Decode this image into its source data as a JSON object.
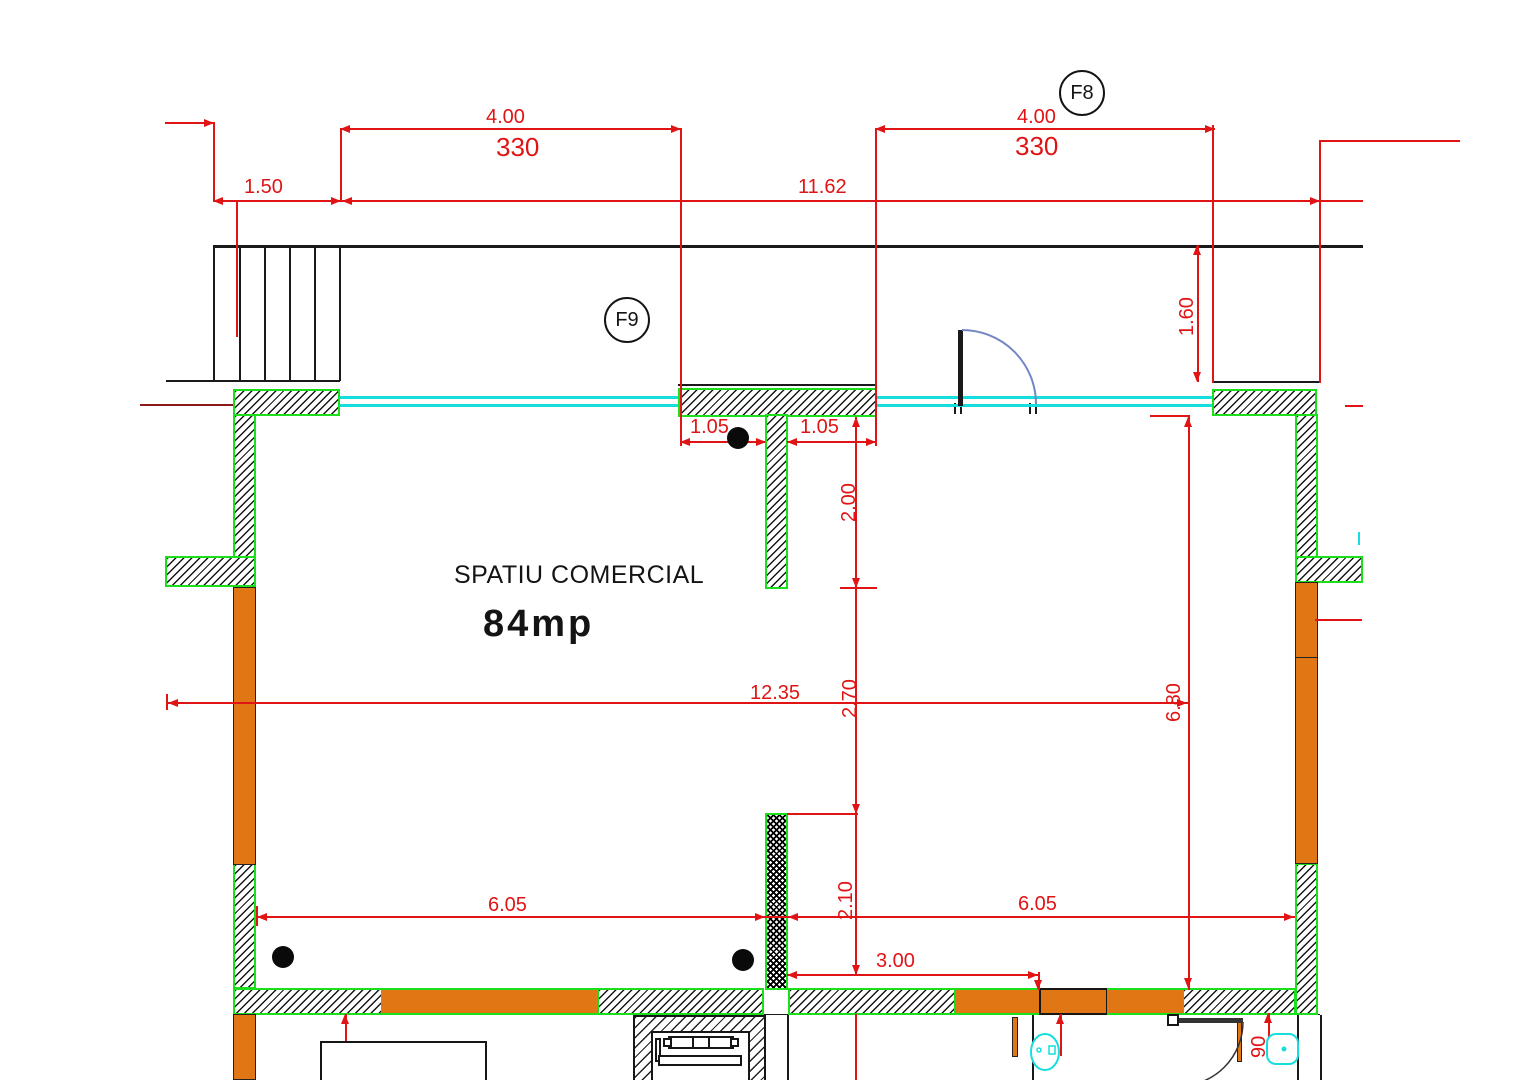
{
  "room": {
    "name": "SPATIU COMERCIAL",
    "area_label": "84mp"
  },
  "grid_bubbles": {
    "f8": "F8",
    "f9": "F9"
  },
  "dimensions": {
    "top_left_offset": "1.50",
    "window_left_width": "4.00",
    "window_left_mm": "330",
    "total_width": "11.62",
    "window_right_width": "4.00",
    "window_right_mm": "330",
    "door_recess_depth": "1.60",
    "pier_left": "1.05",
    "pier_right": "1.05",
    "partition_upper_length": "2.00",
    "room_width": "12.35",
    "mid_depth": "2.70",
    "right_depth": "6.80",
    "bottom_left_width": "6.05",
    "bottom_right_width": "6.05",
    "partition_lower_length": "2.10",
    "opening_width": "3.00",
    "door_width_cm": "90"
  },
  "colors": {
    "dimension_red": "#e01414",
    "wall_outline_green": "#1cdf1c",
    "column_orange": "#e07714",
    "window_cyan": "#17dede",
    "door_arc_blue": "#7486c4",
    "line_black": "#1a1a1a"
  }
}
